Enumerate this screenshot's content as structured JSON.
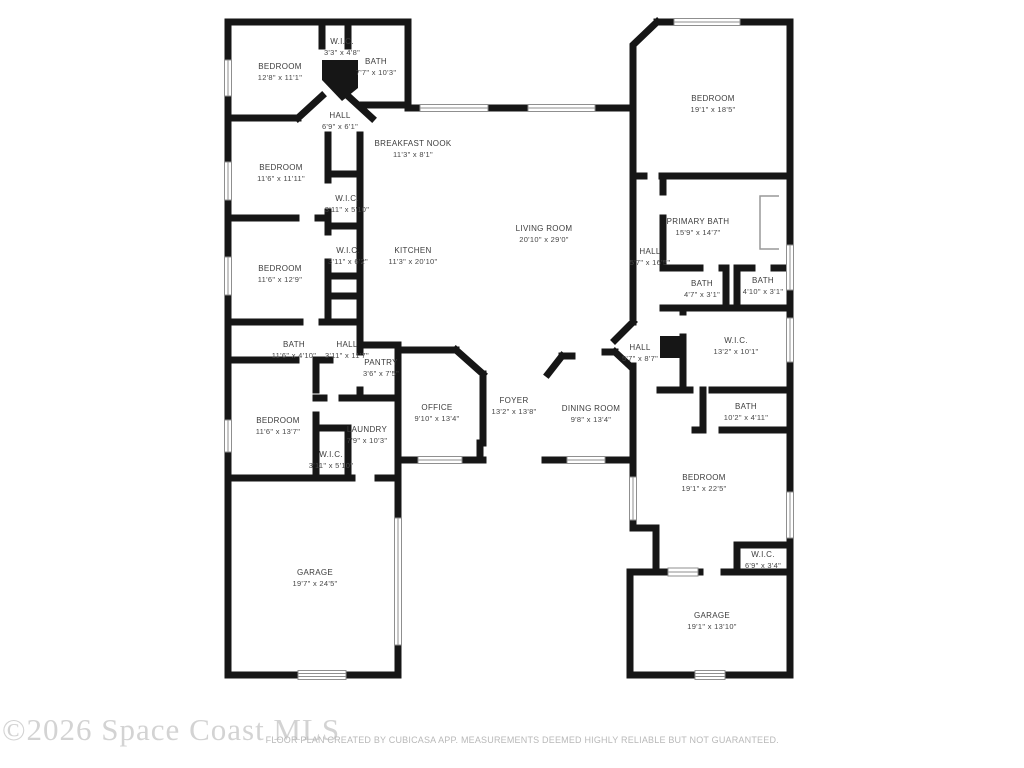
{
  "watermark": {
    "text": "©2026 Space Coast MLS",
    "color": "#d3d3d3"
  },
  "footer": {
    "disclaimer": "FLOOR PLAN CREATED BY CUBICASA APP. MEASUREMENTS DEEMED HIGHLY RELIABLE BUT NOT GUARANTEED."
  },
  "colors": {
    "wall": "#161616",
    "label": "#3c3c3c",
    "window": "#8f8f8f",
    "background": "#ffffff"
  },
  "rooms": [
    {
      "id": "wic-top-left",
      "name": "W.I.C.",
      "dims": "3'3\" x 4'8\""
    },
    {
      "id": "bedroom-top-left",
      "name": "BEDROOM",
      "dims": "12'8\" x 11'1\""
    },
    {
      "id": "bath-top-left",
      "name": "BATH",
      "dims": "7'7\" x 10'3\""
    },
    {
      "id": "hall-top-left",
      "name": "HALL",
      "dims": "6'9\" x 6'1\""
    },
    {
      "id": "breakfast-nook",
      "name": "BREAKFAST NOOK",
      "dims": "11'3\" x 8'1\""
    },
    {
      "id": "bedroom-top-right",
      "name": "BEDROOM",
      "dims": "19'1\" x 18'5\""
    },
    {
      "id": "bedroom-left-2",
      "name": "BEDROOM",
      "dims": "11'6\" x 11'11\""
    },
    {
      "id": "wic-left-1",
      "name": "W.I.C.",
      "dims": "3'11\" x 5'10\""
    },
    {
      "id": "wic-left-2",
      "name": "W.I.C.",
      "dims": "3'11\" x 6'2\""
    },
    {
      "id": "kitchen",
      "name": "KITCHEN",
      "dims": "11'3\" x 20'10\""
    },
    {
      "id": "bedroom-left-3",
      "name": "BEDROOM",
      "dims": "11'6\" x 12'9\""
    },
    {
      "id": "living-room",
      "name": "LIVING ROOM",
      "dims": "20'10\" x 29'0\""
    },
    {
      "id": "hall-right",
      "name": "HALL",
      "dims": "5'7\" x 16'5\""
    },
    {
      "id": "primary-bath",
      "name": "PRIMARY BATH",
      "dims": "15'9\" x 14'7\""
    },
    {
      "id": "bath-small-left",
      "name": "BATH",
      "dims": "4'7\" x 3'1\""
    },
    {
      "id": "bath-small-right",
      "name": "BATH",
      "dims": "4'10\" x 3'1\""
    },
    {
      "id": "bath-left-wing",
      "name": "BATH",
      "dims": "11'6\" x 4'10\""
    },
    {
      "id": "hall-left-wing",
      "name": "HALL",
      "dims": "3'11\" x 11'7\""
    },
    {
      "id": "pantry",
      "name": "PANTRY",
      "dims": "3'6\" x 7'5\""
    },
    {
      "id": "wic-primary",
      "name": "W.I.C.",
      "dims": "13'2\" x 10'1\""
    },
    {
      "id": "hall-center",
      "name": "HALL",
      "dims": "5'7\" x 8'7\""
    },
    {
      "id": "office",
      "name": "OFFICE",
      "dims": "9'10\" x 13'4\""
    },
    {
      "id": "foyer",
      "name": "FOYER",
      "dims": "13'2\" x 13'8\""
    },
    {
      "id": "dining-room",
      "name": "DINING ROOM",
      "dims": "9'8\" x 13'4\""
    },
    {
      "id": "bath-right-wing",
      "name": "BATH",
      "dims": "10'2\" x 4'11\""
    },
    {
      "id": "bedroom-left-4",
      "name": "BEDROOM",
      "dims": "11'6\" x 13'7\""
    },
    {
      "id": "laundry",
      "name": "LAUNDRY",
      "dims": "7'9\" x 10'3\""
    },
    {
      "id": "wic-laundry",
      "name": "W.I.C.",
      "dims": "3'11\" x 5'10\""
    },
    {
      "id": "bedroom-bottom-right",
      "name": "BEDROOM",
      "dims": "19'1\" x 22'5\""
    },
    {
      "id": "wic-bottom-right",
      "name": "W.I.C.",
      "dims": "6'9\" x 3'4\""
    },
    {
      "id": "garage-left",
      "name": "GARAGE",
      "dims": "19'7\" x 24'5\""
    },
    {
      "id": "garage-right",
      "name": "GARAGE",
      "dims": "19'1\" x 13'10\""
    }
  ]
}
